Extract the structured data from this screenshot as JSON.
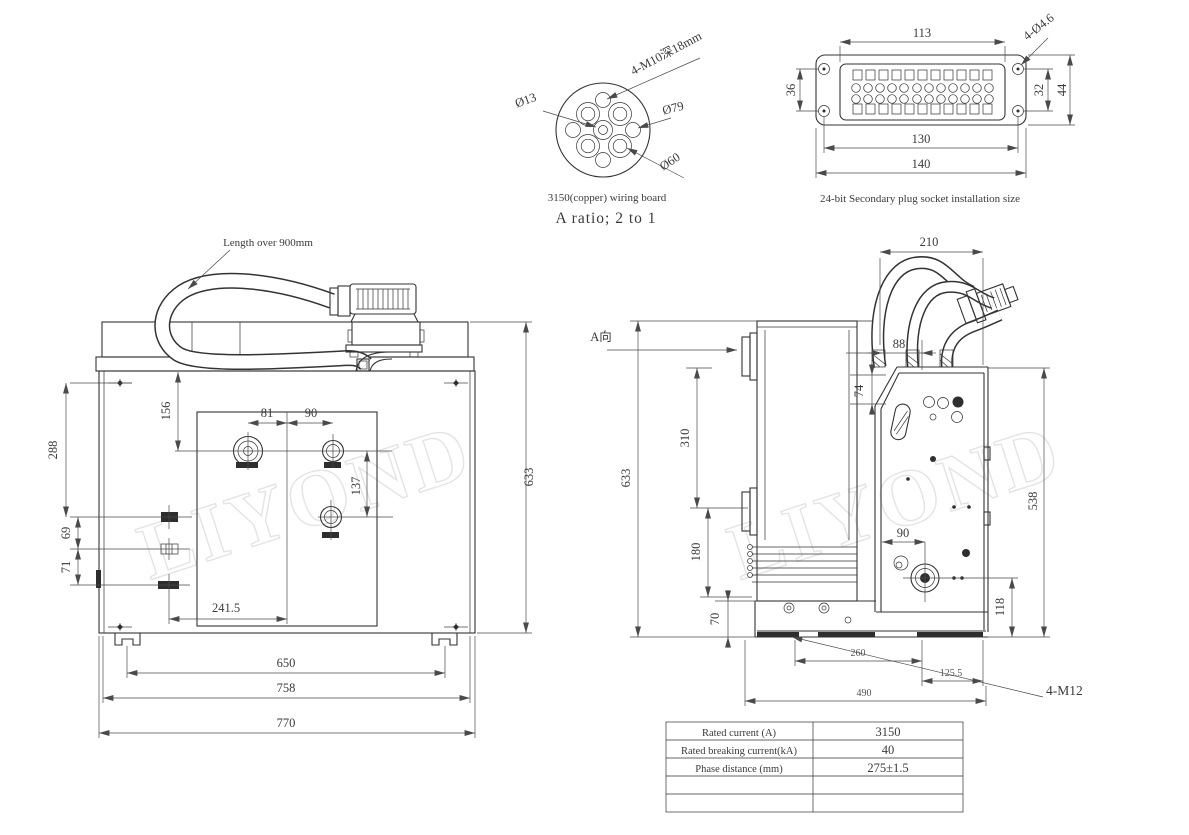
{
  "detail_a": {
    "label_bolt_holes": "4-M10深18mm",
    "label_d13": "Ø13",
    "label_d79": "Ø79",
    "label_d60": "Ø60",
    "caption": "3150(copper) wiring board",
    "ratio_note": "A ratio; 2 to 1"
  },
  "plug_socket": {
    "dim_113": "113",
    "dim_holes": "4-Ø4.6",
    "dim_36": "36",
    "dim_32": "32",
    "dim_44": "44",
    "dim_130": "130",
    "dim_140": "140",
    "caption": "24-bit Secondary plug socket installation size"
  },
  "front_view": {
    "cable_note": "Length over 900mm",
    "dim_288": "288",
    "dim_156": "156",
    "dim_81": "81",
    "dim_90": "90",
    "dim_137": "137",
    "dim_69": "69",
    "dim_71": "71",
    "dim_241_5": "241.5",
    "dim_650": "650",
    "dim_758": "758",
    "dim_770": "770",
    "dim_633": "633"
  },
  "side_view": {
    "view_label": "A向",
    "dim_210": "210",
    "dim_88": "88",
    "dim_74": "74",
    "dim_633": "633",
    "dim_310": "310",
    "dim_180": "180",
    "dim_70": "70",
    "dim_90": "90",
    "dim_118": "118",
    "dim_538": "538",
    "dim_260": "260",
    "dim_125_5": "125.5",
    "dim_490": "490",
    "bolt_label": "4-M12"
  },
  "spec_table": {
    "rows": [
      {
        "label": "Rated current (A)",
        "value": "3150"
      },
      {
        "label": "Rated breaking current(kA)",
        "value": "40"
      },
      {
        "label": "Phase distance (mm)",
        "value": "275±1.5"
      },
      {
        "label": "",
        "value": ""
      },
      {
        "label": "",
        "value": ""
      }
    ]
  },
  "watermark": "LIYOND",
  "colors": {
    "line": "#333333",
    "dim_line": "#4a4a4a",
    "text": "#3a3a3a",
    "bg": "#ffffff"
  }
}
